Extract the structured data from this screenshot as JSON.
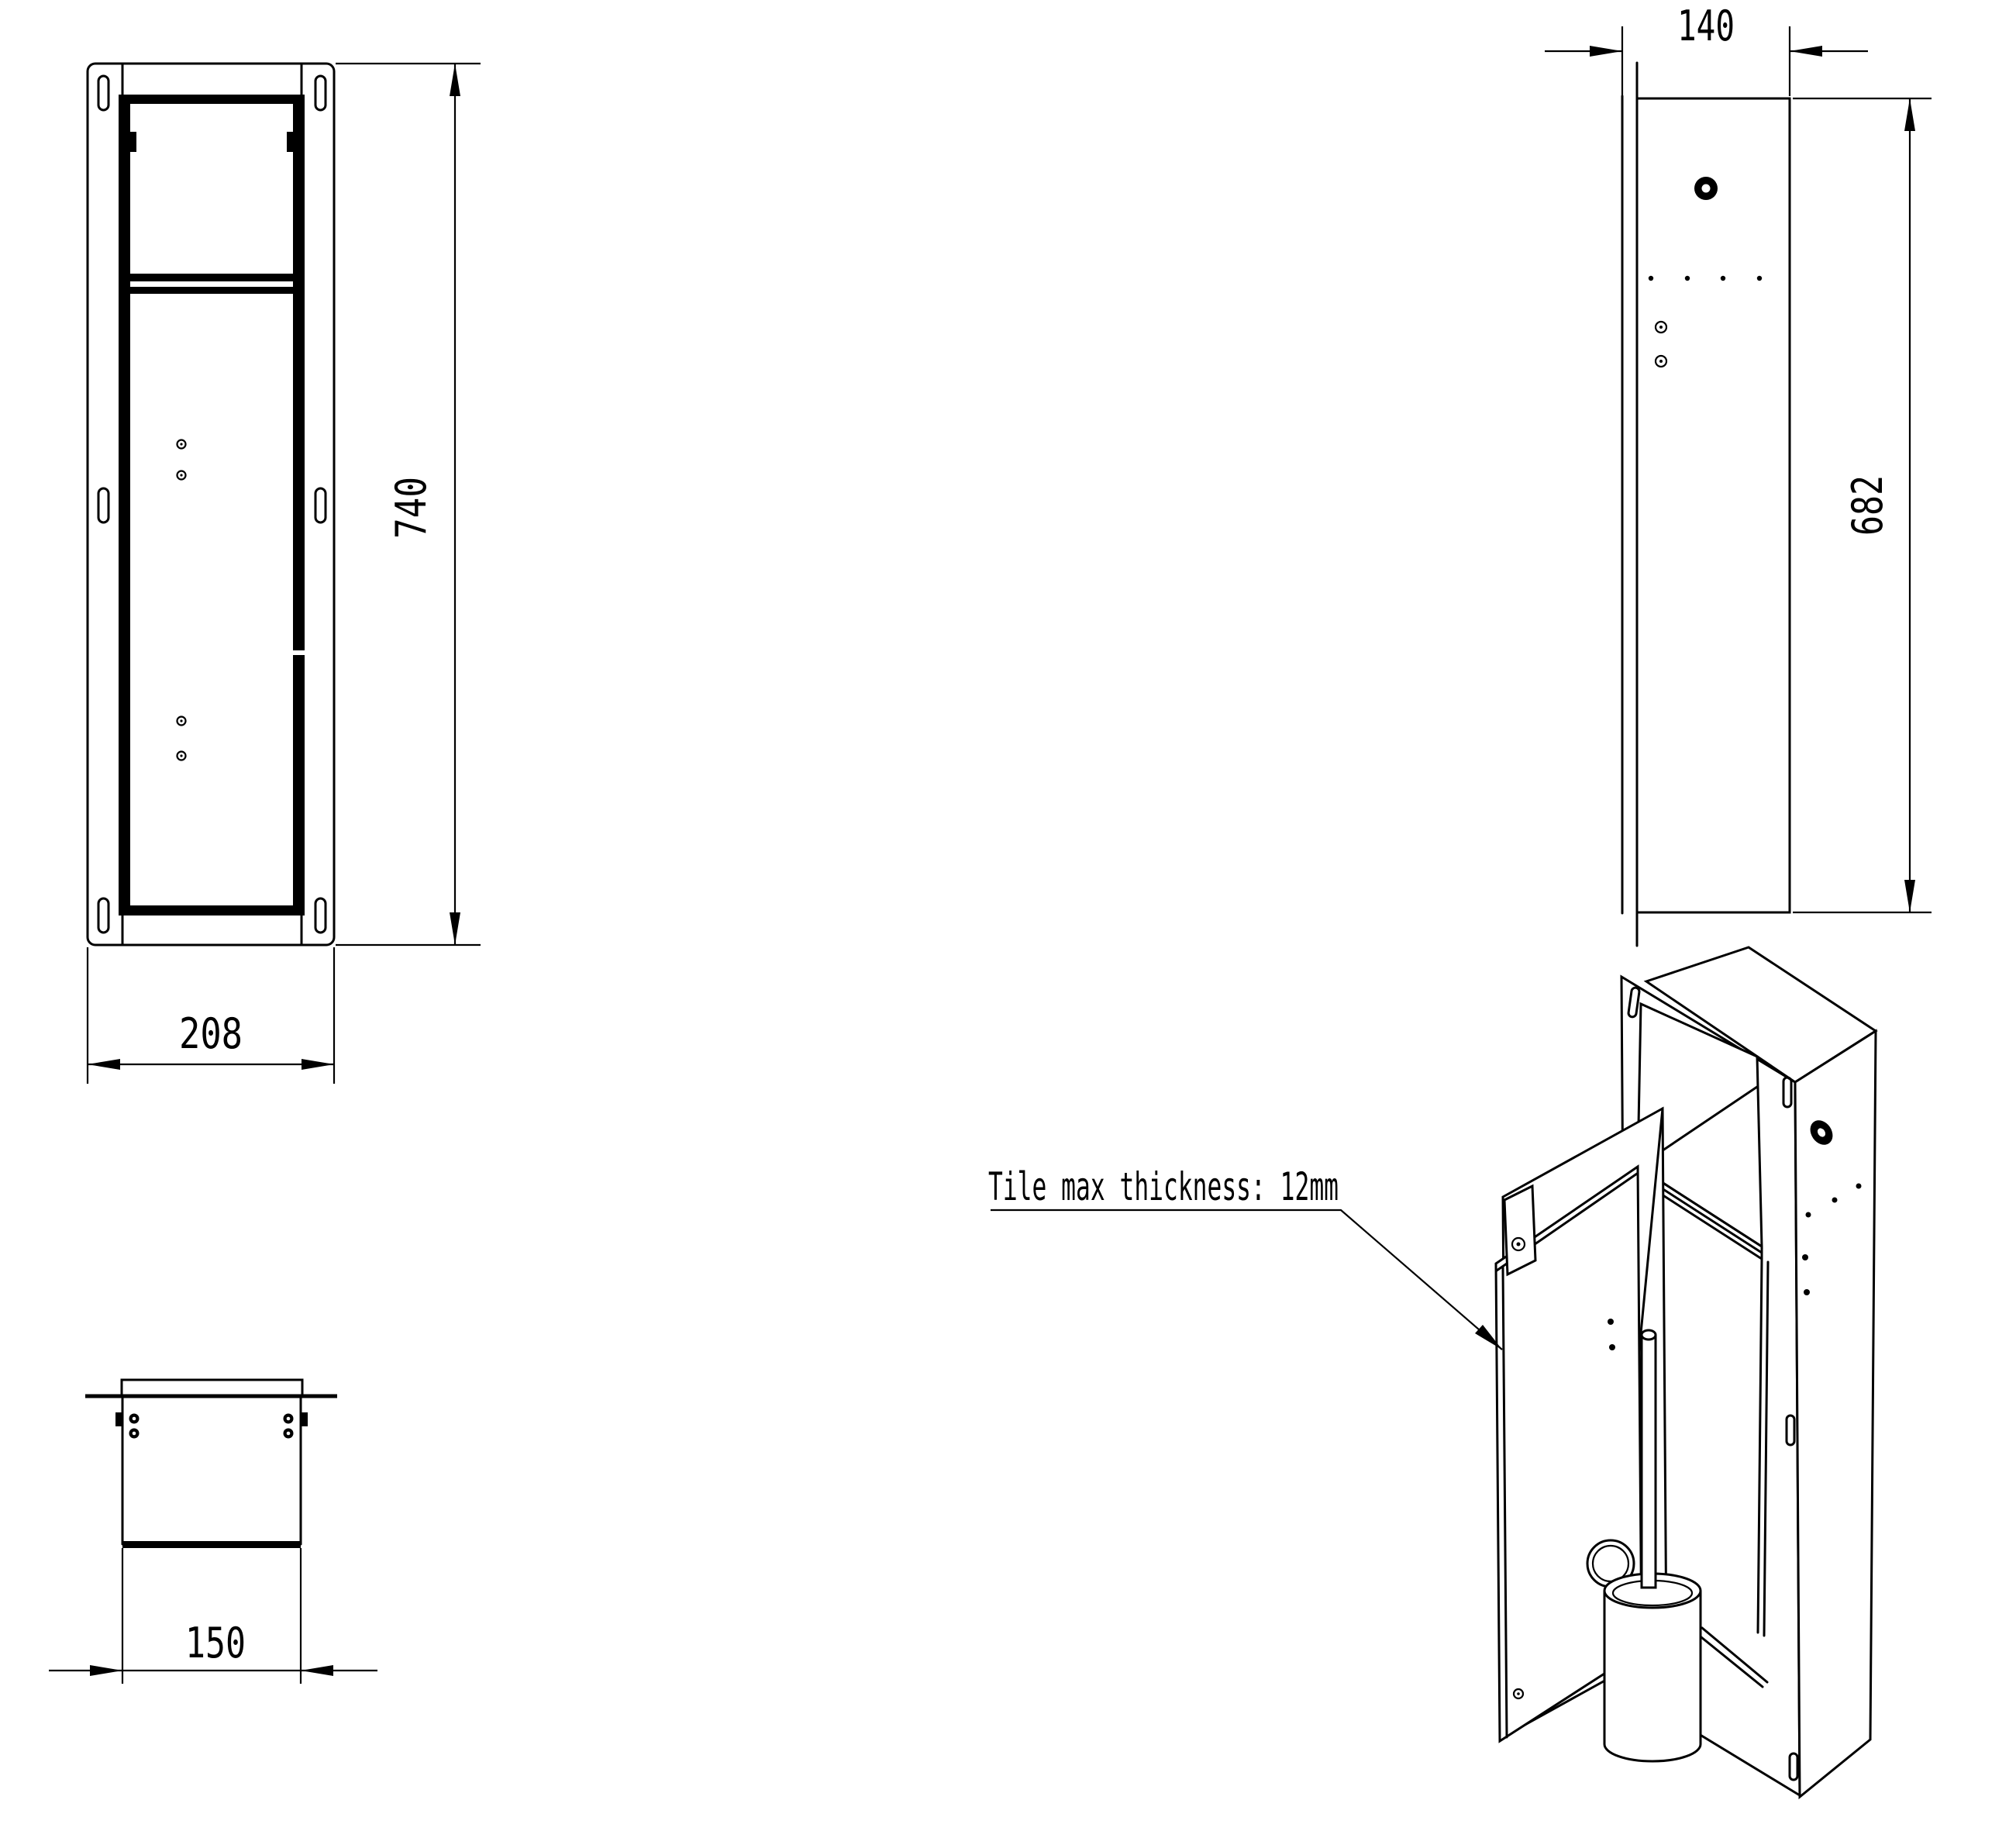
{
  "dimensions": {
    "front_height_mm": "740",
    "front_width_mm": "208",
    "side_depth_mm": "140",
    "side_height_mm": "682",
    "top_width_mm": "150"
  },
  "annotation": {
    "tile_note": "Tile max thickness: 12mm"
  },
  "colors": {
    "line": "#000000",
    "background": "#ffffff"
  }
}
